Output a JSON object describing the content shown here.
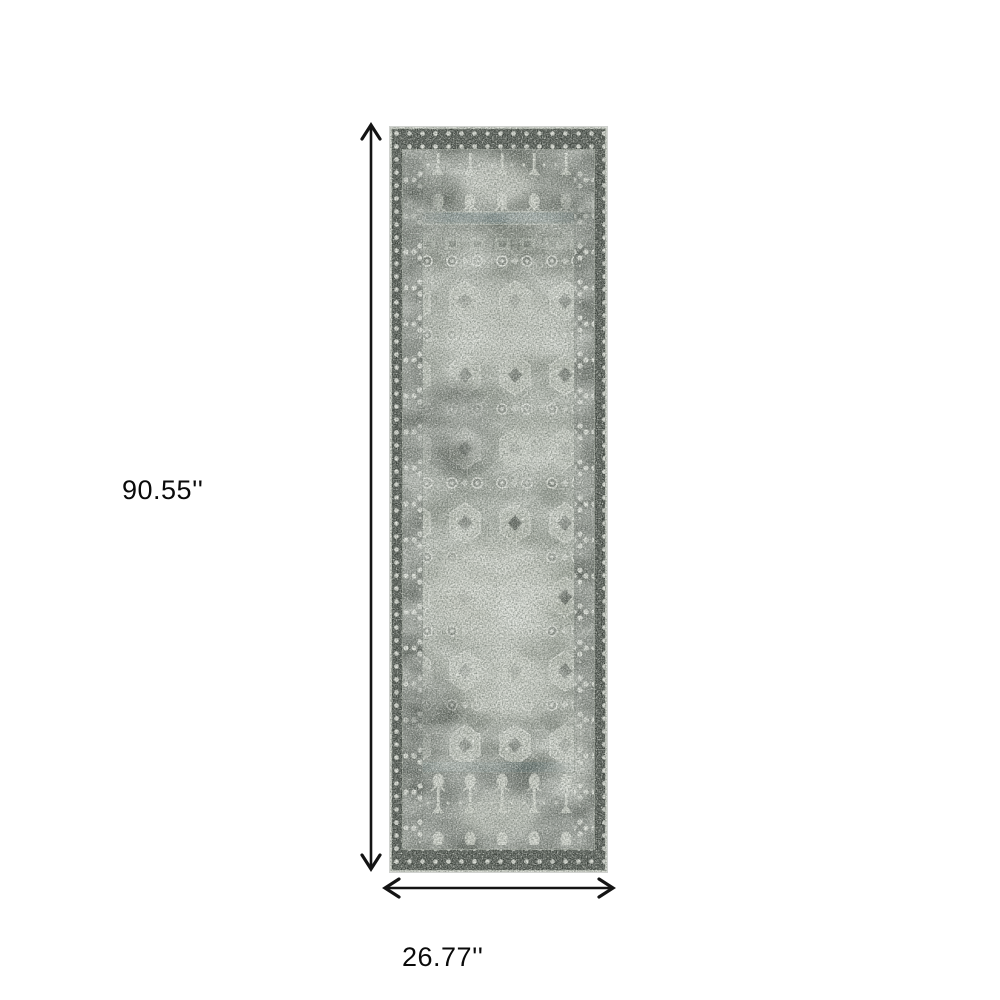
{
  "page": {
    "background_color": "#ffffff"
  },
  "diagram": {
    "height_label": "90.55''",
    "width_label": "26.77''",
    "arrow_color": "#141414",
    "label_color": "#0a0a0a"
  },
  "rug": {
    "kind": "runner-rug-product-photo",
    "palette": {
      "border_dark": "#363c36",
      "binding_light": "#b7bcb2",
      "field_mid": "#6a7167",
      "field_light": "#c7cabf",
      "motif_white": "#e6e8e0",
      "motif_dark": "#2c322b",
      "divider_teal": "#54696c"
    }
  }
}
